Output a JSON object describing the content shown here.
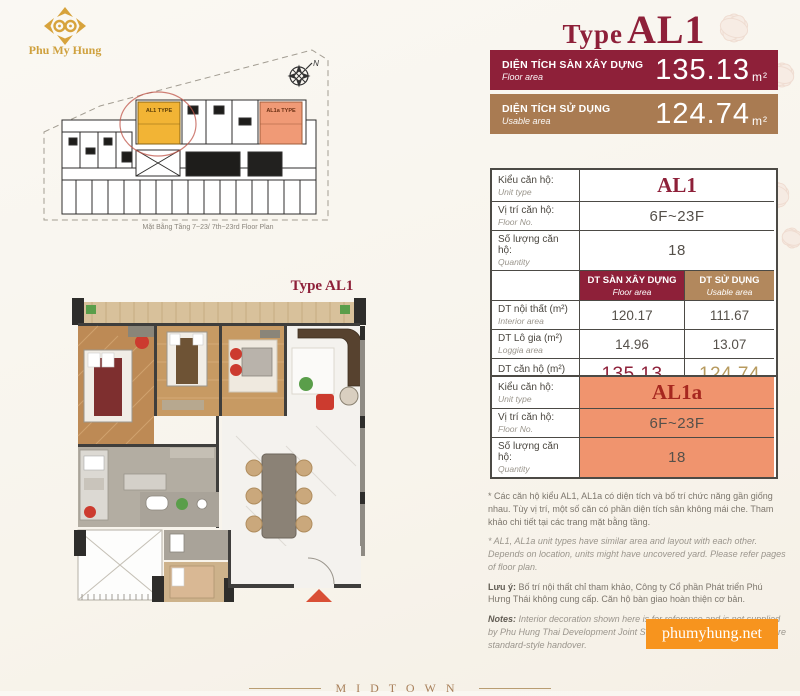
{
  "logo": {
    "brand": "Phu My Hung"
  },
  "title": {
    "prefix": "Type",
    "code": "AL1"
  },
  "banners": [
    {
      "label_vi": "DIỆN TÍCH SÀN XÂY DỰNG",
      "label_en": "Floor area",
      "value": "135.13",
      "unit": "m²"
    },
    {
      "label_vi": "DIỆN TÍCH SỬ DỤNG",
      "label_en": "Usable area",
      "value": "124.74",
      "unit": "m²"
    }
  ],
  "site_plan": {
    "caption": "Mặt Bằng Tầng 7~23/ 7th~23rd Floor Plan",
    "north_label": "N",
    "highlight_unit": "AL1 TYPE",
    "highlight_unit_alt": "AL1a TYPE",
    "highlight_color": "#f2b435",
    "highlight_alt_color": "#f09a76"
  },
  "unit_plan": {
    "label": "Type AL1"
  },
  "table1": {
    "rows": [
      {
        "label_vi": "Kiểu căn hộ:",
        "label_en": "Unit type",
        "value": "AL1"
      },
      {
        "label_vi": "Vị trí căn hộ:",
        "label_en": "Floor No.",
        "value": "6F~23F"
      },
      {
        "label_vi": "Số lượng căn hộ:",
        "label_en": "Quantity",
        "value": "18"
      }
    ],
    "col_headers": [
      {
        "label_vi": "DT SÀN XÂY DỰNG",
        "label_en": "Floor area"
      },
      {
        "label_vi": "DT SỬ DỤNG",
        "label_en": "Usable area"
      }
    ],
    "area_rows": [
      {
        "label_vi": "DT nội thất (m²)",
        "label_en": "Interior area",
        "floor": "120.17",
        "usable": "111.67"
      },
      {
        "label_vi": "DT Lô gia (m²)",
        "label_en": "Loggia area",
        "floor": "14.96",
        "usable": "13.07"
      },
      {
        "label_vi": "DT căn hộ (m²)",
        "label_en": "Unit area",
        "floor": "135.13",
        "usable": "124.74"
      }
    ]
  },
  "table2": {
    "rows": [
      {
        "label_vi": "Kiểu căn hộ:",
        "label_en": "Unit type",
        "value": "AL1a"
      },
      {
        "label_vi": "Vị trí căn hộ:",
        "label_en": "Floor No.",
        "value": "6F~23F"
      },
      {
        "label_vi": "Số lượng căn hộ:",
        "label_en": "Quantity",
        "value": "18"
      }
    ]
  },
  "footnotes": {
    "vi1": "* Các căn hộ kiểu AL1, AL1a có diện tích và bố trí chức năng gần giống nhau. Tùy vị trí, một số căn có phần diện tích sân không mái che. Tham khảo chi tiết tại các trang mặt bằng tầng.",
    "en1": "* AL1, AL1a unit types have similar area and layout with each other. Depends on location, units might have uncovered yard. Please refer pages of floor plan.",
    "note_vi_label": "Lưu ý:",
    "note_vi": "Bố trí nội thất chỉ tham khảo, Công ty Cổ phần Phát triển Phú Hưng Thái không cung cấp. Căn hộ bàn giao hoàn thiện cơ bản.",
    "note_en_label": "Notes:",
    "note_en": "Interior decoration shown here is for reference and is not supplied by Phu Hung Thai Development Joint Stock Company. The apartments are standard-style handover."
  },
  "footer": {
    "website": "phumyhung.net",
    "project": "MIDTOWN"
  },
  "colors": {
    "brand_red": "#8e2039",
    "brand_tan": "#a97b52",
    "salmon": "#f0946e",
    "orange": "#f7941e",
    "gold": "#d7a33c"
  }
}
